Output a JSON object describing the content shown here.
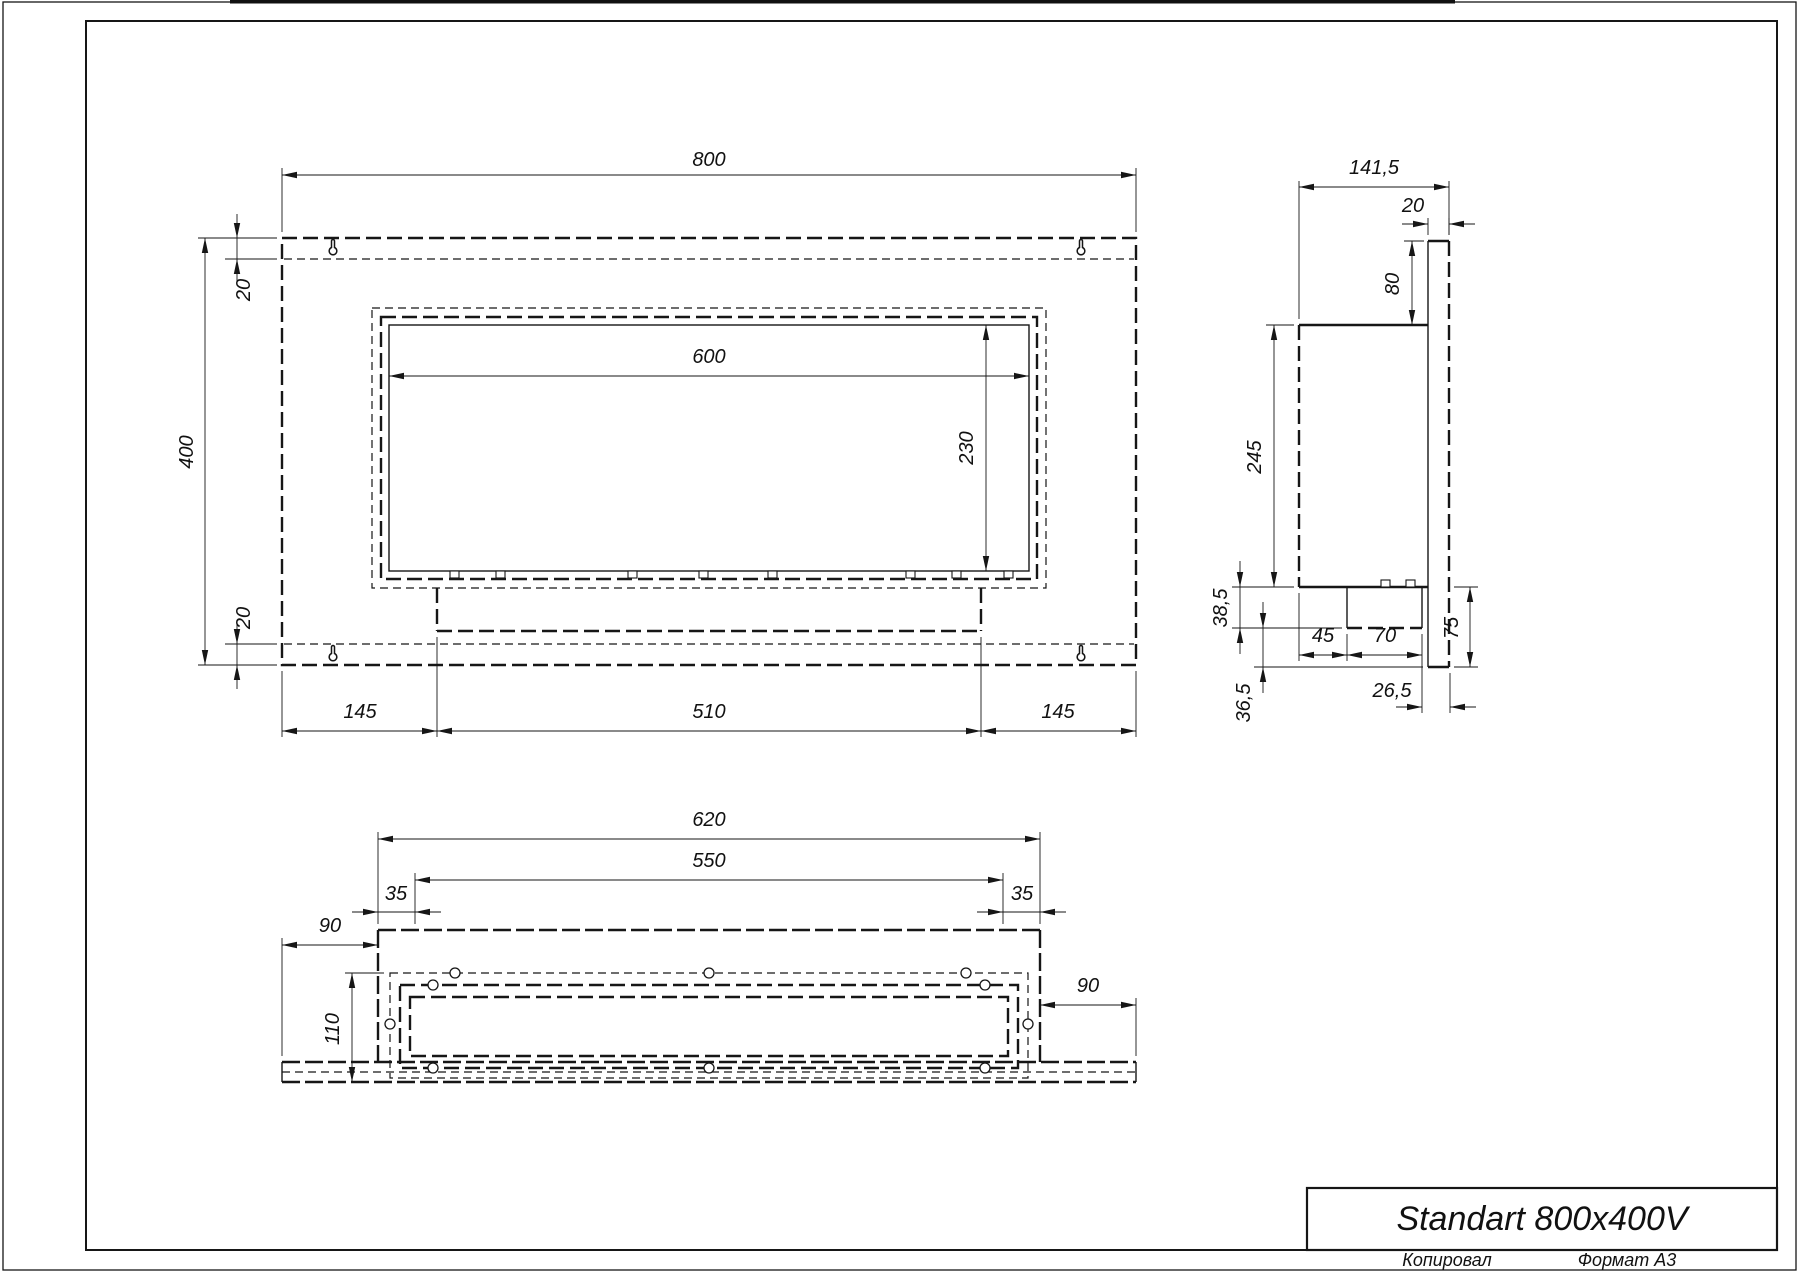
{
  "title_block": {
    "title": "Standart 800x400V"
  },
  "footer": {
    "copied_label": "Копировал",
    "format_label": "Формат A3"
  },
  "front_view": {
    "dims": {
      "overall_width": "800",
      "overall_height": "400",
      "top_offset": "20",
      "bottom_offset": "20",
      "opening_width": "600",
      "opening_height": "230",
      "left_margin": "145",
      "burner_length": "510",
      "right_margin": "145"
    }
  },
  "side_view": {
    "dims": {
      "overall_depth": "141,5",
      "panel_thickness": "20",
      "top_offset": "80",
      "body_height": "245",
      "burner_drop": "38,5",
      "burner_offset": "45",
      "burner_depth": "70",
      "lower_gap": "36,5",
      "rear_offset": "26,5",
      "panel_drop": "75"
    }
  },
  "bottom_view": {
    "dims": {
      "box_width": "620",
      "insert_width": "550",
      "left_inset": "35",
      "right_inset": "35",
      "left_flange": "90",
      "right_flange": "90",
      "depth": "110"
    }
  }
}
